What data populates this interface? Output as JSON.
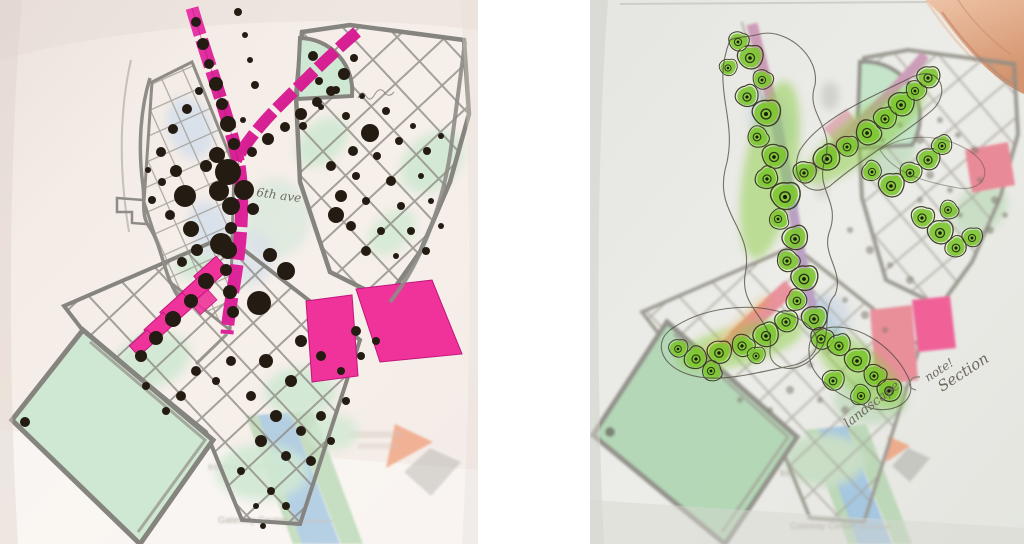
{
  "colors": {
    "page_background": "#ffffff",
    "left_paper": "#f4ede7",
    "right_paper": "#e9eae5",
    "magenta_corridor": "#df2398",
    "bright_pink_block": "#f23a9b",
    "salmon_pink_block": "#ec7f8d",
    "pale_green_parcel": "#cfe8d3",
    "park_green": "#b9dfbd",
    "pale_blue_parcel": "#d3deeb",
    "pencil_gray": "#8e8c86",
    "tree_dot_black": "#241c12",
    "canopy_green": "#7cc62f",
    "canopy_outline": "#3c421f",
    "river_blue": "#8cbade",
    "riverside_green": "#a8d0a4",
    "base_orange": "#ef8e63",
    "skin_tone": "#e4ad8f"
  },
  "left_photo": {
    "base_map": {
      "international_plaza_label": "International Plaza",
      "gateway_center_label": "Gateway Center"
    },
    "handwriting": {
      "street_note": "6th ave"
    }
  },
  "right_photo": {
    "base_map": {
      "international_plaza_label": "International Plaza",
      "gateway_center_label": "Gateway Center"
    },
    "handwriting": {
      "arm_label": "landscape",
      "callout_note": "note!",
      "section_note": "Section"
    }
  }
}
